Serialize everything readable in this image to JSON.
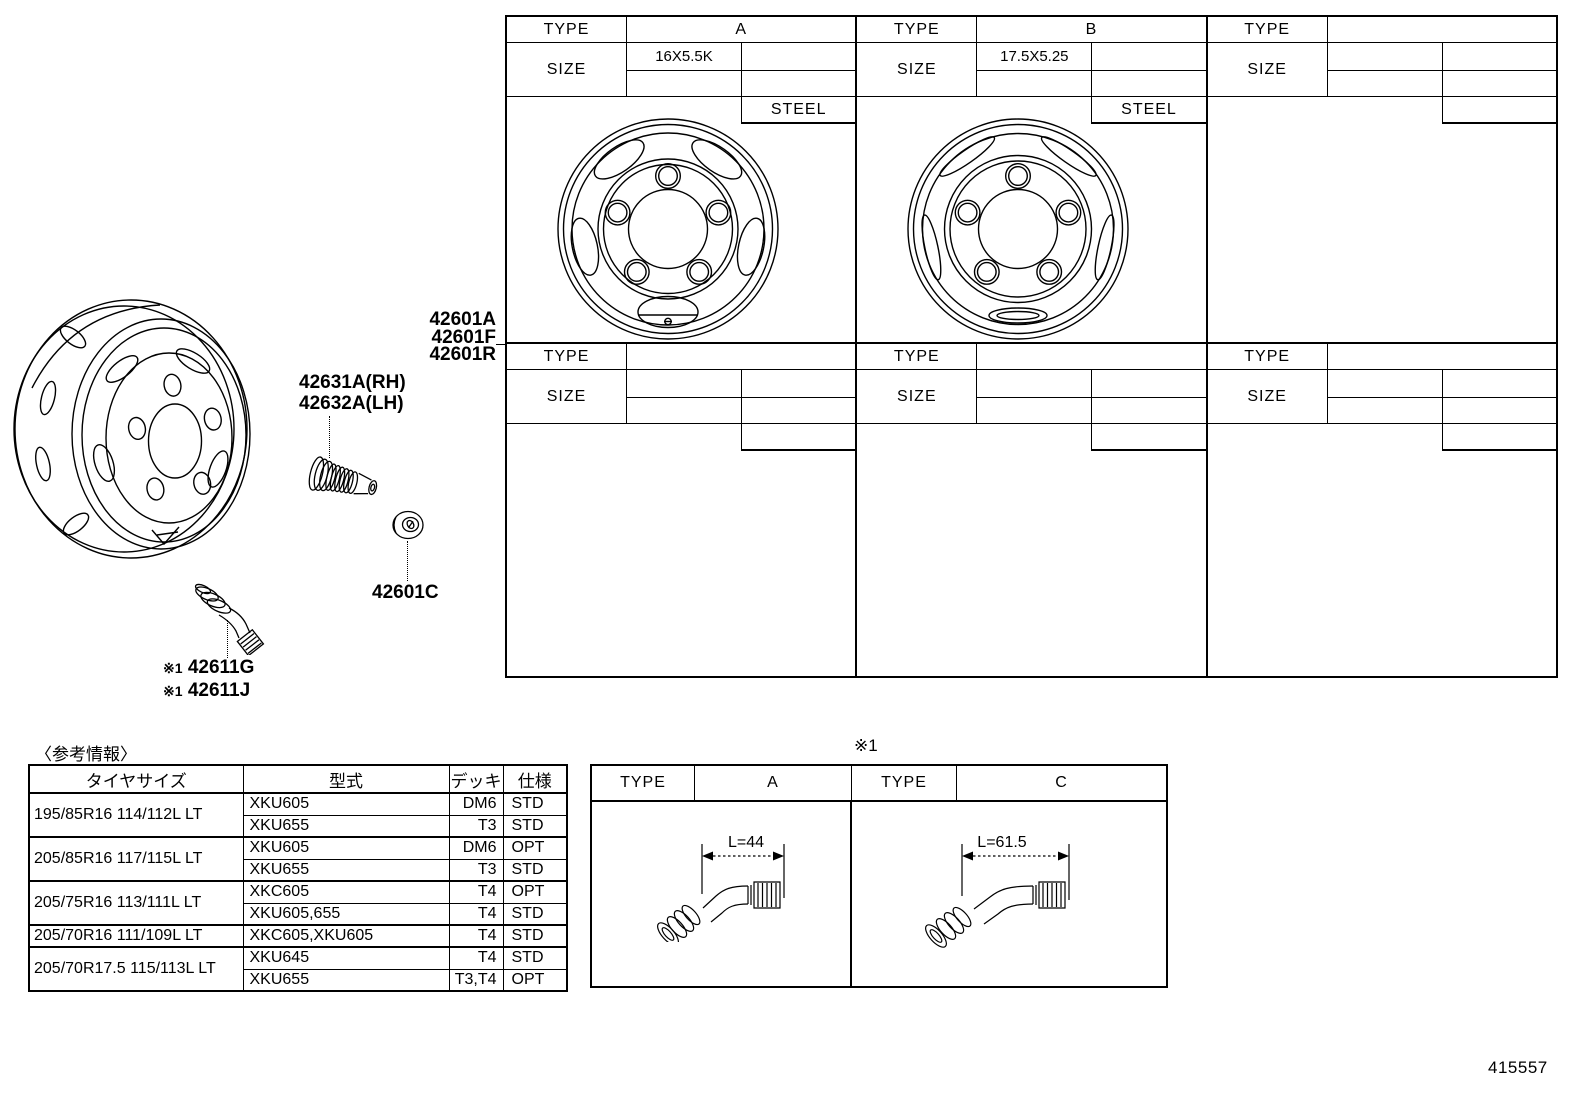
{
  "wheel_table": {
    "panels_top": [
      {
        "type_label": "TYPE",
        "type_value": "A",
        "size_label": "SIZE",
        "size_value": "16X5.5K",
        "material": "STEEL"
      },
      {
        "type_label": "TYPE",
        "type_value": "B",
        "size_label": "SIZE",
        "size_value": "17.5X5.25",
        "material": "STEEL"
      },
      {
        "type_label": "TYPE",
        "type_value": "",
        "size_label": "SIZE",
        "size_value": "",
        "material": ""
      }
    ],
    "panels_bottom": [
      {
        "type_label": "TYPE",
        "type_value": "",
        "size_label": "SIZE",
        "size_value": "",
        "material": ""
      },
      {
        "type_label": "TYPE",
        "type_value": "",
        "size_label": "SIZE",
        "size_value": "",
        "material": ""
      },
      {
        "type_label": "TYPE",
        "type_value": "",
        "size_label": "SIZE",
        "size_value": "",
        "material": ""
      }
    ]
  },
  "callouts": {
    "wheel_codes": [
      "42601A",
      "42601F",
      "42601R"
    ],
    "bolt_rh": "42631A(RH)",
    "bolt_lh": "42632A(LH)",
    "nut": "42601C",
    "note": "※1",
    "valve_g": "42611G",
    "valve_j": "42611J"
  },
  "reference_table": {
    "caption": "〈参考情報〉",
    "headers": [
      "タイヤサイズ",
      "型式",
      "デッキ",
      "仕様"
    ],
    "groups": [
      {
        "tire": "195/85R16 114/112L LT",
        "rows": [
          [
            "XKU605",
            "DM6",
            "STD"
          ],
          [
            "XKU655",
            "T3",
            "STD"
          ]
        ]
      },
      {
        "tire": "205/85R16 117/115L LT",
        "rows": [
          [
            "XKU605",
            "DM6",
            "OPT"
          ],
          [
            "XKU655",
            "T3",
            "STD"
          ]
        ]
      },
      {
        "tire": "205/75R16 113/111L LT",
        "rows": [
          [
            "XKC605",
            "T4",
            "OPT"
          ],
          [
            "XKU605,655",
            "T4",
            "STD"
          ]
        ]
      },
      {
        "tire": "205/70R16 111/109L LT",
        "rows": [
          [
            "XKC605,XKU605",
            "T4",
            "STD"
          ]
        ]
      },
      {
        "tire": "205/70R17.5 115/113L LT",
        "rows": [
          [
            "XKU645",
            "T4",
            "STD"
          ],
          [
            "XKU655",
            "T3,T4",
            "OPT"
          ]
        ]
      }
    ]
  },
  "valve_table": {
    "note": "※1",
    "type_a_label": "TYPE",
    "type_a_value": "A",
    "type_c_label": "TYPE",
    "type_c_value": "C",
    "dim_a": "L=44",
    "dim_c": "L=61.5"
  },
  "figure_number": "415557"
}
